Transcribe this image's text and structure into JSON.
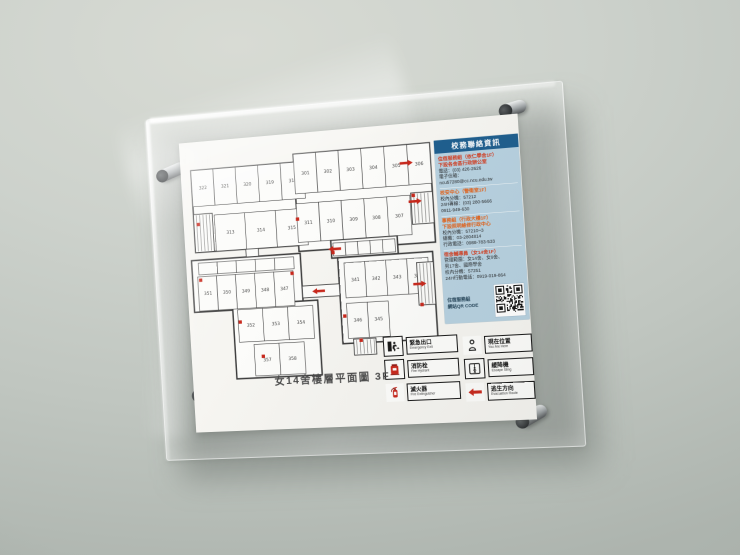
{
  "scene": {
    "wall_color": "#c6ccc6",
    "acrylic_hardware": "silver-standoff-pins"
  },
  "sign": {
    "title": "女14舍樓層平面圖 3F",
    "contact_panel": {
      "header": "校務聯絡資訊",
      "header_color": "#1e5e8e",
      "panel_color": "#b7d1e0",
      "sections": [
        {
          "title_color": "#d23b1e",
          "title_lines": [
            "住宿服務組（依仁學舍1F）",
            "下設各舍區行政辦公室"
          ],
          "lines": [
            "電話：(03) 426-2626",
            "電子信箱：",
            "ncu57280@cc.ncu.edu.tw"
          ]
        },
        {
          "title_color": "#e2621a",
          "title_lines": [
            "校安中心（警衛室1F）"
          ],
          "lines": [
            "校內分機：57212",
            "24H專線：(03) 280-5666",
            "0911-949-630"
          ]
        },
        {
          "title_color": "#e2621a",
          "title_lines": [
            "事務組（行政大樓1F）",
            "下設照明維修行政中心"
          ],
          "lines": [
            "校內分機：57210~3",
            "總機：03-2804814",
            "行政電話：0988-783-533"
          ]
        },
        {
          "title_color": "#d23b1e",
          "title_lines": [
            "宿舍輔導員（女14舍1F）"
          ],
          "lines": [
            "管理範圍：女14舍、女9舍、",
            "男17舍、國際學舍",
            "校內分機：57251",
            "24H行動電話：0919-019-864"
          ]
        }
      ],
      "qr_caption_lines": [
        "住宿服務組",
        "網站QR CODE"
      ]
    },
    "legend": {
      "items": [
        {
          "zh": "緊急出口",
          "en": "Emergency Exit",
          "icon": "emergency-exit",
          "boxed": true
        },
        {
          "zh": "消防栓",
          "en": "Fire Hydrant",
          "icon": "fire-hydrant",
          "boxed": true
        },
        {
          "zh": "滅火器",
          "en": "Fire Extinguisher",
          "icon": "fire-extinguisher",
          "boxed": false
        },
        {
          "zh": "現在位置",
          "en": "You Are Here",
          "icon": "you-are-here",
          "boxed": false
        },
        {
          "zh": "緩降機",
          "en": "Escape Sling",
          "icon": "escape-sling",
          "boxed": true
        },
        {
          "zh": "逃生方向",
          "en": "Evacuation Route",
          "icon": "evacuation-route",
          "boxed": false
        }
      ]
    },
    "floorplan": {
      "viewbox": "0 0 510 500",
      "wall_color": "#3a3a3a",
      "room_fill": "#fcfcfa",
      "label_color": "#454545",
      "accent_red": "#c8271b",
      "blocks": [
        [
          14,
          38,
          236,
          168
        ],
        [
          230,
          22,
          275,
          196
        ],
        [
          4,
          222,
          228,
          106
        ],
        [
          296,
          200,
          134,
          36
        ],
        [
          308,
          236,
          190,
          172
        ],
        [
          85,
          318,
          177,
          150
        ]
      ],
      "rooms": [
        {
          "x": 14,
          "y": 38,
          "w": 47,
          "h": 74,
          "label": "322"
        },
        {
          "x": 61,
          "y": 38,
          "w": 47,
          "h": 74,
          "label": "321"
        },
        {
          "x": 108,
          "y": 38,
          "w": 47,
          "h": 74,
          "label": "320"
        },
        {
          "x": 155,
          "y": 38,
          "w": 47,
          "h": 74,
          "label": "319"
        },
        {
          "x": 202,
          "y": 38,
          "w": 48,
          "h": 74,
          "label": "318"
        },
        {
          "x": 58,
          "y": 132,
          "w": 64,
          "h": 74,
          "label": "313"
        },
        {
          "x": 122,
          "y": 132,
          "w": 64,
          "h": 74,
          "label": "314"
        },
        {
          "x": 186,
          "y": 132,
          "w": 64,
          "h": 74,
          "label": "315"
        },
        {
          "x": 230,
          "y": 22,
          "w": 46,
          "h": 80,
          "label": "301"
        },
        {
          "x": 276,
          "y": 22,
          "w": 46,
          "h": 80,
          "label": "302"
        },
        {
          "x": 322,
          "y": 22,
          "w": 46,
          "h": 80,
          "label": "303"
        },
        {
          "x": 368,
          "y": 22,
          "w": 46,
          "h": 80,
          "label": "304"
        },
        {
          "x": 414,
          "y": 22,
          "w": 46,
          "h": 80,
          "label": "305"
        },
        {
          "x": 460,
          "y": 22,
          "w": 45,
          "h": 80,
          "label": "306"
        },
        {
          "x": 230,
          "y": 122,
          "w": 46,
          "h": 78,
          "label": "311"
        },
        {
          "x": 276,
          "y": 122,
          "w": 46,
          "h": 78,
          "label": "310"
        },
        {
          "x": 322,
          "y": 122,
          "w": 46,
          "h": 78,
          "label": "309"
        },
        {
          "x": 368,
          "y": 122,
          "w": 46,
          "h": 78,
          "label": "308"
        },
        {
          "x": 414,
          "y": 122,
          "w": 46,
          "h": 78,
          "label": "307"
        },
        {
          "x": 18,
          "y": 228,
          "w": 40,
          "h": 24
        },
        {
          "x": 58,
          "y": 228,
          "w": 40,
          "h": 24
        },
        {
          "x": 98,
          "y": 228,
          "w": 40,
          "h": 24
        },
        {
          "x": 138,
          "y": 228,
          "w": 40,
          "h": 24
        },
        {
          "x": 178,
          "y": 228,
          "w": 40,
          "h": 24
        },
        {
          "x": 15,
          "y": 256,
          "w": 40,
          "h": 70,
          "label": "351"
        },
        {
          "x": 55,
          "y": 256,
          "w": 40,
          "h": 70,
          "label": "350"
        },
        {
          "x": 95,
          "y": 256,
          "w": 40,
          "h": 70,
          "label": "349"
        },
        {
          "x": 135,
          "y": 256,
          "w": 40,
          "h": 70,
          "label": "348"
        },
        {
          "x": 175,
          "y": 256,
          "w": 40,
          "h": 70,
          "label": "347"
        },
        {
          "x": 300,
          "y": 206,
          "w": 25,
          "h": 26
        },
        {
          "x": 325,
          "y": 206,
          "w": 25,
          "h": 26
        },
        {
          "x": 350,
          "y": 206,
          "w": 25,
          "h": 26
        },
        {
          "x": 375,
          "y": 206,
          "w": 25,
          "h": 26
        },
        {
          "x": 400,
          "y": 206,
          "w": 25,
          "h": 26
        },
        {
          "x": 320,
          "y": 247,
          "w": 42,
          "h": 70,
          "label": "341"
        },
        {
          "x": 362,
          "y": 247,
          "w": 42,
          "h": 70,
          "label": "342"
        },
        {
          "x": 404,
          "y": 247,
          "w": 42,
          "h": 70,
          "label": "343"
        },
        {
          "x": 446,
          "y": 247,
          "w": 42,
          "h": 70,
          "label": "344"
        },
        {
          "x": 320,
          "y": 328,
          "w": 42,
          "h": 70,
          "label": "346"
        },
        {
          "x": 362,
          "y": 328,
          "w": 42,
          "h": 70,
          "label": "345"
        },
        {
          "x": 95,
          "y": 328,
          "w": 52,
          "h": 66,
          "label": "352"
        },
        {
          "x": 147,
          "y": 328,
          "w": 52,
          "h": 66,
          "label": "353"
        },
        {
          "x": 199,
          "y": 328,
          "w": 52,
          "h": 66,
          "label": "354"
        },
        {
          "x": 125,
          "y": 400,
          "w": 52,
          "h": 64,
          "label": "357"
        },
        {
          "x": 177,
          "y": 400,
          "w": 52,
          "h": 64,
          "label": "358"
        }
      ],
      "corridors": [
        [
          120,
          206,
          26,
          16
        ],
        [
          232,
          288,
          76,
          24
        ]
      ],
      "stairs": [
        [
          14,
          128,
          40,
          78
        ],
        [
          462,
          118,
          43,
          62
        ],
        [
          465,
          256,
          33,
          84
        ],
        [
          330,
          400,
          45,
          32
        ]
      ],
      "arrows": [
        {
          "x": 252,
          "y": 300,
          "dir": "left"
        },
        {
          "x": 290,
          "y": 218,
          "dir": "left"
        },
        {
          "x": 483,
          "y": 135,
          "dir": "right"
        },
        {
          "x": 482,
          "y": 298,
          "dir": "right"
        },
        {
          "x": 470,
          "y": 58,
          "dir": "right"
        }
      ],
      "equipment": [
        [
          20,
          146
        ],
        [
          228,
          150
        ],
        [
          296,
          222
        ],
        [
          312,
          350
        ],
        [
          96,
          350
        ],
        [
          140,
          422
        ],
        [
          342,
          400
        ],
        [
          464,
          120
        ],
        [
          468,
          336
        ],
        [
          210,
          258
        ],
        [
          18,
          260
        ]
      ]
    }
  }
}
